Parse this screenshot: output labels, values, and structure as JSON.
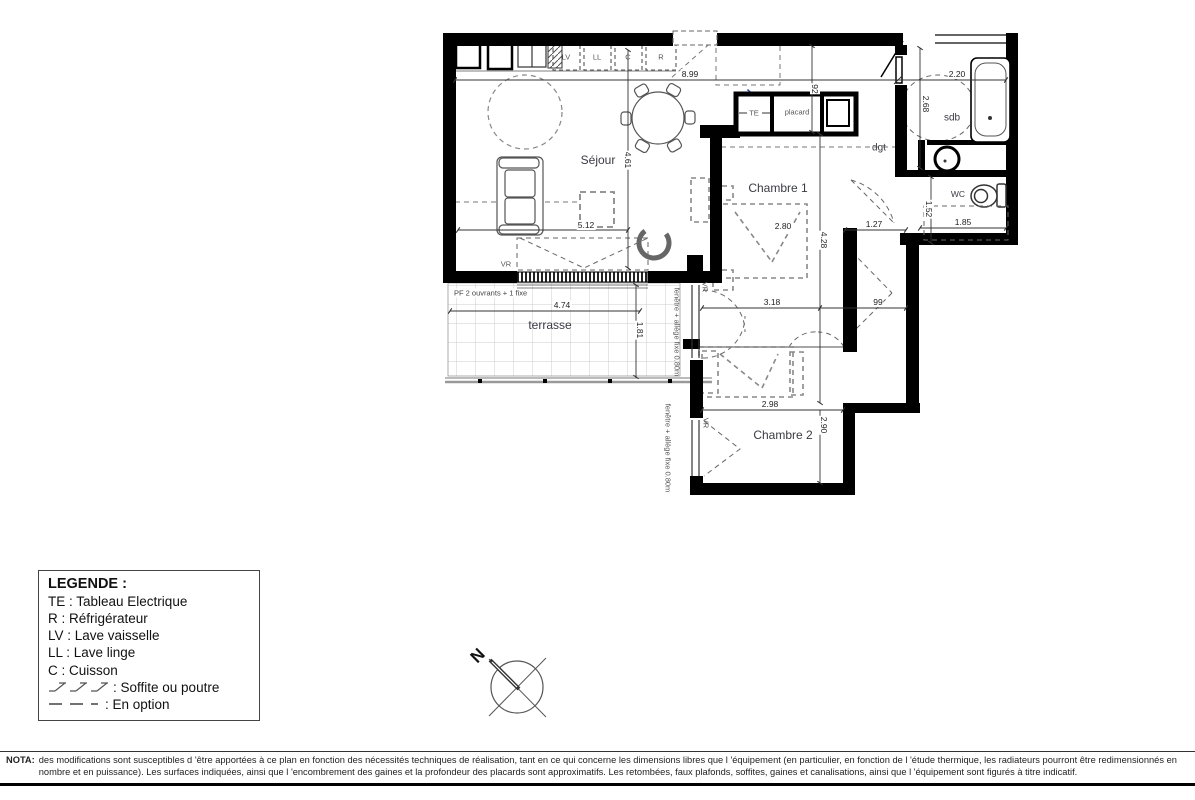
{
  "plan": {
    "room_labels": {
      "sejour": "Séjour",
      "chambre1": "Chambre 1",
      "chambre2": "Chambre 2",
      "sdb": "sdb",
      "wc": "WC",
      "dgt": "dgt",
      "terrasse": "terrasse",
      "placard": "placard"
    },
    "equipment_labels": {
      "lv": "LV",
      "ll": "LL",
      "c": "C",
      "r": "R",
      "te": "TE"
    },
    "window_labels": {
      "vr": "VR",
      "pf": "PF 2 ouvrants + 1 fixe",
      "fenetre_chambre1": "fenêtre + allège fixe 0.80m",
      "fenetre_chambre2": "fenêtre + allège fixe 0.80m"
    },
    "dimensions": {
      "sejour_width": "8.99",
      "sejour_depth": "4.61",
      "sejour_inner": "5.12",
      "entry_width": "92",
      "sdb_width": "2.20",
      "sdb_depth": "2.68",
      "wc_depth": "1.52",
      "wc_width": "1.85",
      "dgt_width": "1.27",
      "chambre1_depth": "4.28",
      "chambre1_width": "3.18",
      "hall_width": "99",
      "chambre2_width": "2.98",
      "chambre2_depth": "2.90",
      "terrasse_width": "4.74",
      "terrasse_depth": "1.81"
    }
  },
  "legend": {
    "title": "LEGENDE :",
    "items": [
      {
        "text": "TE : Tableau Electrique"
      },
      {
        "text": "R : Réfrigérateur"
      },
      {
        "text": "LV : Lave vaisselle"
      },
      {
        "text": "LL : Lave linge"
      },
      {
        "text": "C : Cuisson"
      },
      {
        "symbol": "soffite",
        "text": ": Soffite ou poutre"
      },
      {
        "symbol": "option",
        "text": ": En option"
      }
    ]
  },
  "compass": {
    "north": "N"
  },
  "nota": {
    "label": "NOTA:",
    "text": "des modifications sont susceptibles d 'être apportées à ce plan en fonction des nécessités techniques de réalisation, tant en ce qui concerne les dimensions libres que l 'équipement (en particulier, en fonction de l 'étude thermique, les radiateurs pourront être redimensionnés en nombre et en puissance). Les surfaces indiquées, ainsi que l 'encombrement des gaines et la profondeur des placards sont approximatifs. Les retombées, faux plafonds, soffites, gaines et canalisations, ainsi que l 'équipement sont figurés à titre indicatif."
  },
  "colors": {
    "wall": "#000000",
    "dimension": "#333333",
    "accent_blue": "#3355bb"
  }
}
